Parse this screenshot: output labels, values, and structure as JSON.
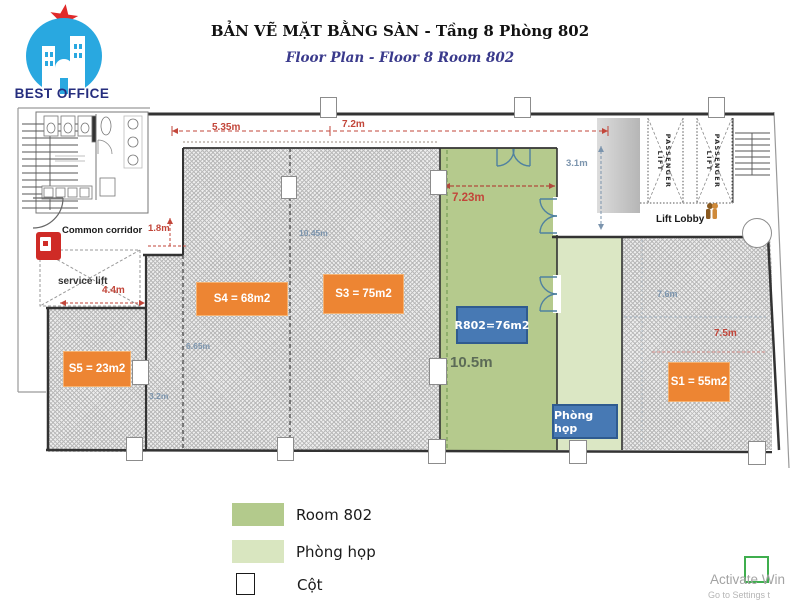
{
  "header": {
    "brand": "BEST OFFICE",
    "title": "BẢN VẼ MẶT BẰNG SÀN - Tầng 8 Phòng 802",
    "subtitle": "Floor Plan - Floor 8 Room 802"
  },
  "rooms": {
    "s5": "S5 = 23m2",
    "s4": "S4 = 68m2",
    "s3": "S3 = 75m2",
    "s1": "S1 = 55m2",
    "r802": "R802=76m2",
    "meeting": "Phòng họp"
  },
  "areas": {
    "common_corridor": "Common corridor",
    "service_lift": "service lift",
    "lift_lobby": "Lift Lobby",
    "passenger_lift_1": "PASSENGER LIFT",
    "passenger_lift_2": "PASSENGER LIFT"
  },
  "dims": {
    "d535": "5.35m",
    "d72": "7.2m",
    "d723": "7.23m",
    "d31": "3.1m",
    "d18": "1.8m",
    "d44": "4.4m",
    "d1045": "10.45m",
    "d665": "6.65m",
    "d32": "3.2m",
    "d105": "10.5m",
    "d76": "7.6m",
    "d75": "7.5m"
  },
  "legend": {
    "room802": "Room 802",
    "meeting": "Phòng họp",
    "column": "Cột"
  },
  "watermark": {
    "line1": "Activate Win",
    "line2": "Go to Settings t"
  },
  "colors": {
    "accent_orange": "#ED8533",
    "accent_blue": "#4779B4",
    "room802_green": "#B5CA8D",
    "meeting_green": "#DBE7C4",
    "dim_red": "#C2463A",
    "dim_blue": "#7B94AD",
    "logo_blue": "#29A8E0",
    "brand_navy": "#252D7E",
    "watermark_green": "#3FAE4E"
  }
}
